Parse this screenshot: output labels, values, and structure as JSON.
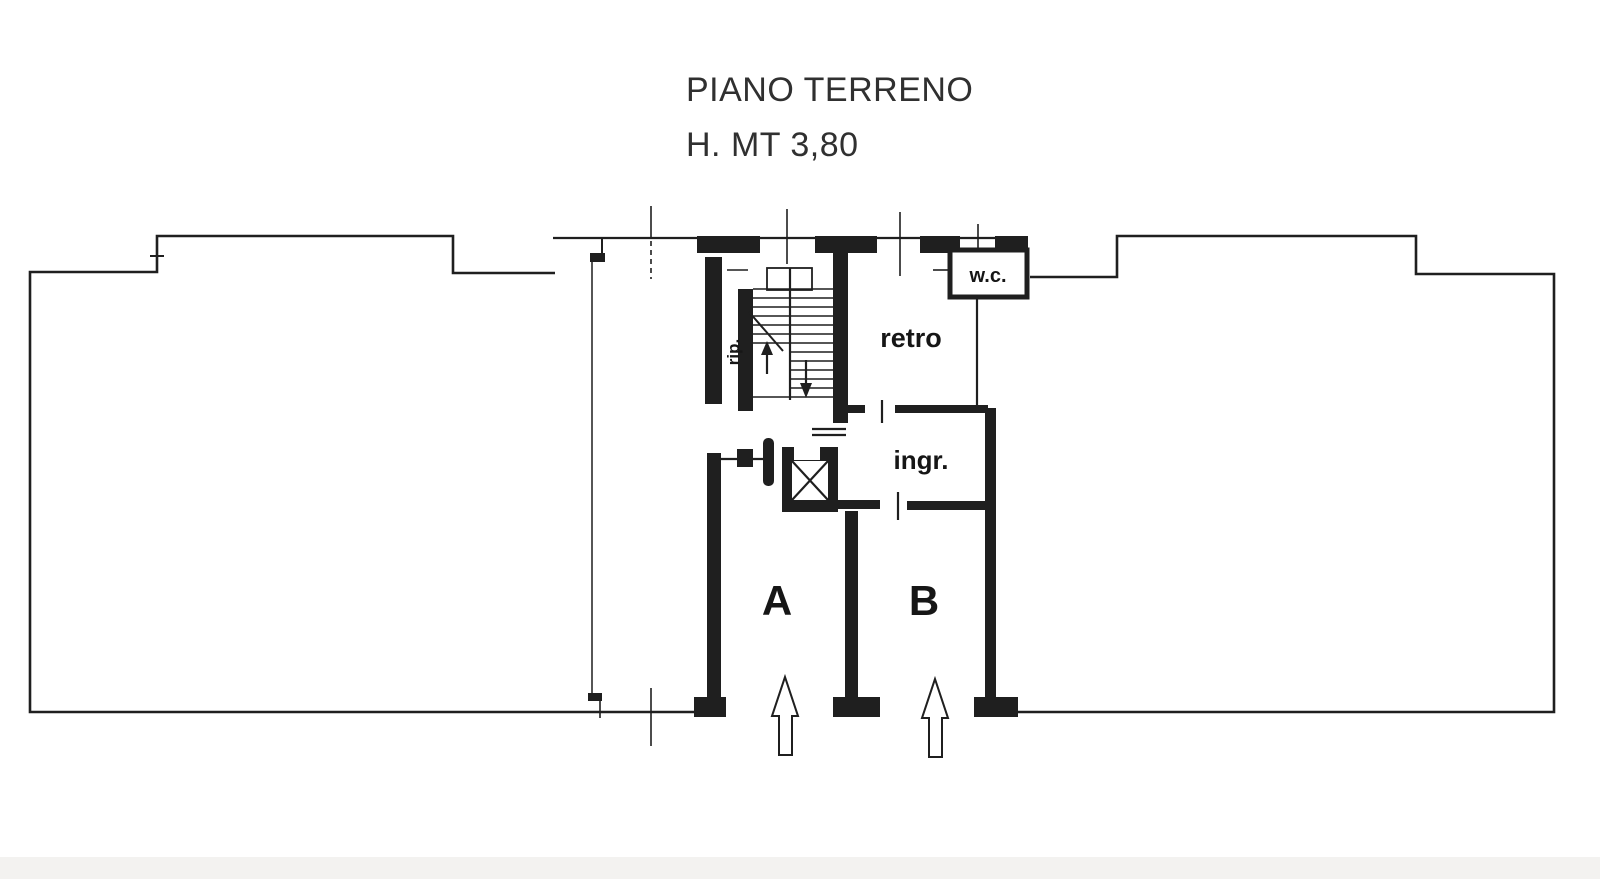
{
  "document": {
    "type": "floor-plan-scan",
    "title_line1": "PIANO TERRENO",
    "title_line2": "H. MT 3,80"
  },
  "rooms": {
    "storage_label": "rip.",
    "back_label": "retro",
    "entrance_label": "ingr.",
    "wc_label": "w.c.",
    "unit_a_label": "A",
    "unit_b_label": "B"
  },
  "icons": {
    "elevator": "crossed-box-elevator-symbol",
    "stairs": "staircase-treads-symbol",
    "entrance_arrow_a": "hollow-up-arrow",
    "entrance_arrow_b": "hollow-up-arrow",
    "stair_up_arrow": "filled-up-arrow",
    "stair_down_arrow": "filled-down-arrow"
  },
  "colors": {
    "ink": "#1f1f1f",
    "paper": "#ffffff",
    "scan_shadow": "#e9e7e3"
  }
}
